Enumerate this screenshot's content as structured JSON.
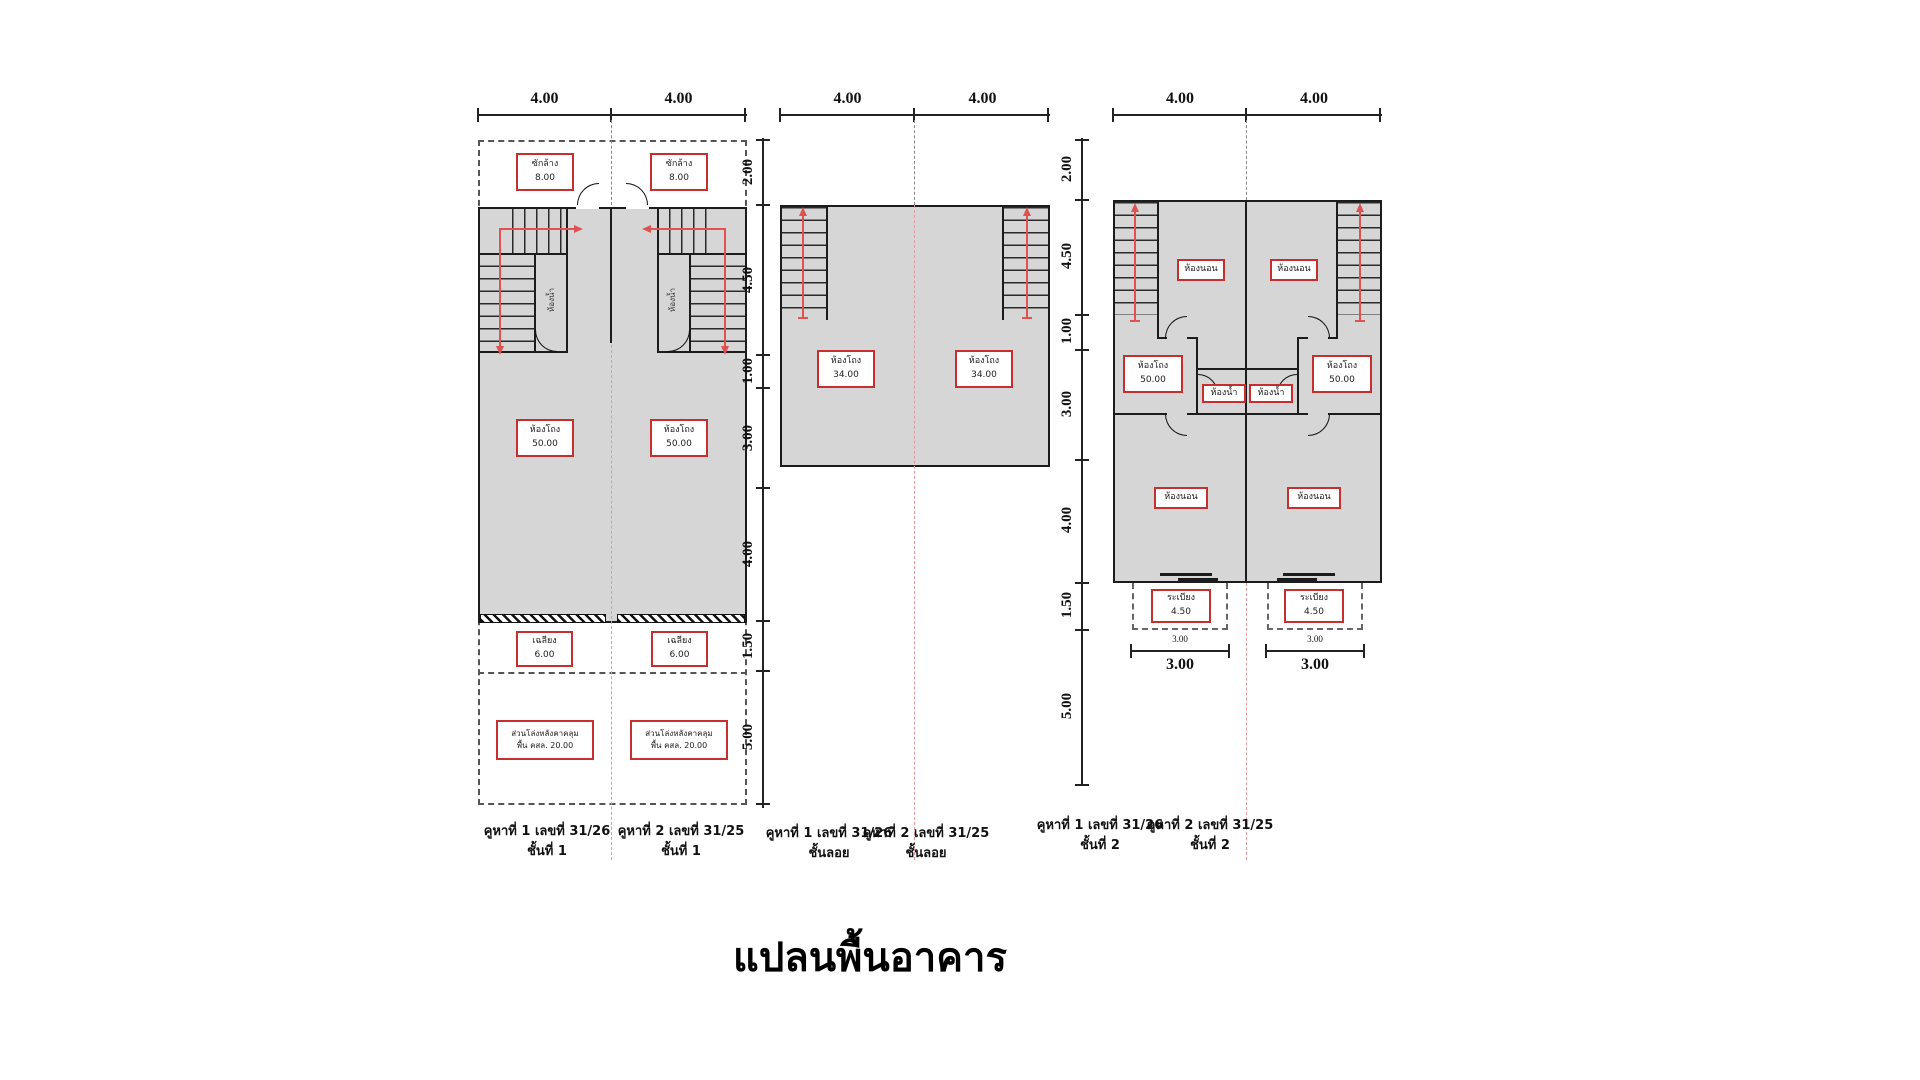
{
  "title": "แปลนพื้นอาคาร",
  "dims": {
    "w4": "4.00",
    "col": [
      "2.00",
      "4.50",
      "1.00",
      "3.00",
      "4.00",
      "1.50",
      "5.00"
    ],
    "balcony_w": "3.00"
  },
  "rooms": {
    "wash": {
      "name": "ซักล้าง",
      "area": "8.00"
    },
    "bath": {
      "name": "ห้องน้ำ"
    },
    "hall1": {
      "name": "ห้องโถง",
      "area": "50.00"
    },
    "hall_mezz": {
      "name": "ห้องโถง",
      "area": "34.00"
    },
    "hall2": {
      "name": "ห้องโถง",
      "area": "50.00"
    },
    "porch": {
      "name": "เฉลียง",
      "area": "6.00"
    },
    "open_area": {
      "name": "ส่วนโล่งหลังคาคลุม",
      "area": "พื้น คสล. 20.00"
    },
    "bedroom": {
      "name": "ห้องนอน"
    },
    "balcony": {
      "name": "ระเบียง",
      "area": "4.50"
    }
  },
  "captions": {
    "unit1": "คูหาที่ 1 เลขที่ 31/26",
    "unit2": "คูหาที่ 2 เลขที่ 31/25",
    "floor1": "ชั้นที่ 1",
    "mezzanine": "ชั้นลอย",
    "floor2": "ชั้นที่ 2"
  },
  "colors": {
    "label_red": "#c5302e",
    "stair_arrow_red": "#e05252",
    "wall": "#1c1c1c",
    "floor_fill": "#d6d6d6",
    "centerline_pink": "#e09a9a"
  }
}
